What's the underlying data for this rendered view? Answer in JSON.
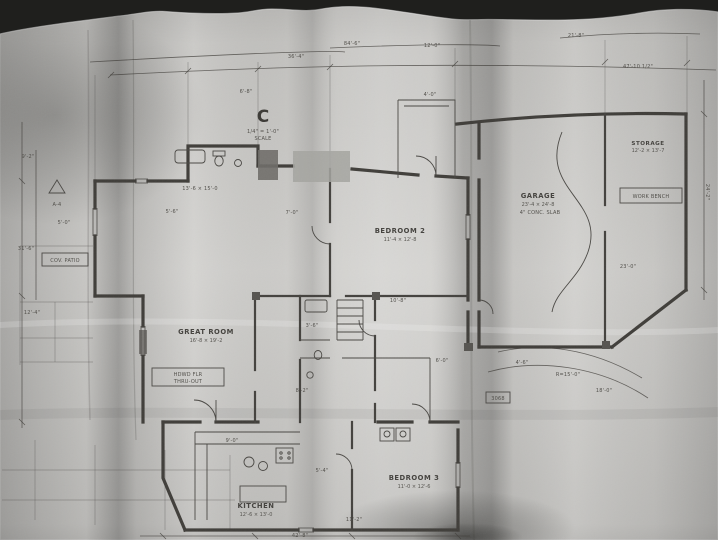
{
  "scene": {
    "type": "photograph of an architectural floor-plan blueprint on curled paper",
    "background_color": "#1f1f1d",
    "paper_color": "#cfcecb",
    "ink_color": "#403e3a",
    "shadow_color": "#8e8c88"
  },
  "plan": {
    "symbols": {
      "north_marker": "C",
      "triangle_note": "A-4"
    },
    "rooms": {
      "garage": {
        "label": "GARAGE",
        "dims": "23'-4 × 24'-8"
      },
      "storage": {
        "label": "STORAGE",
        "dims": "12'-2 × 13'-7"
      },
      "bedroom2": {
        "label": "BEDROOM 2",
        "dims": "11'-4 × 12'-8"
      },
      "great_room": {
        "label": "GREAT ROOM",
        "dims": "16'-8 × 19'-2"
      },
      "kitchen": {
        "label": "KITCHEN",
        "dims": "12'-6 × 13'-0"
      },
      "bedroom3": {
        "label": "BEDROOM 3",
        "dims": "11'-0 × 12'-6"
      }
    },
    "boxes": {
      "patio": "COV. PATIO",
      "workbench": "WORK BENCH",
      "door_tag": "3068"
    },
    "notes": {
      "scale_1": "1/4\" = 1'-0\"",
      "scale_2": "SCALE",
      "floor_1": "HDWD FLR",
      "floor_2": "THRU-OUT",
      "slab": "4\" CONC. SLAB"
    },
    "annotations": [
      {
        "x": 352,
        "y": 45,
        "t": "84'-6\""
      },
      {
        "x": 296,
        "y": 58,
        "t": "36'-4\""
      },
      {
        "x": 432,
        "y": 47,
        "t": "12'-0\""
      },
      {
        "x": 576,
        "y": 37,
        "t": "21'-8\""
      },
      {
        "x": 638,
        "y": 68,
        "t": "47'-10 1/2\""
      },
      {
        "x": 246,
        "y": 93,
        "t": "6'-8\""
      },
      {
        "x": 430,
        "y": 96,
        "t": "4'-0\""
      },
      {
        "x": 28,
        "y": 158,
        "t": "9'-2\""
      },
      {
        "x": 26,
        "y": 250,
        "t": "31'-6\""
      },
      {
        "x": 32,
        "y": 314,
        "t": "12'-4\""
      },
      {
        "x": 64,
        "y": 224,
        "t": "5'-0\""
      },
      {
        "x": 200,
        "y": 190,
        "t": "13'-6 × 15'-0"
      },
      {
        "x": 172,
        "y": 213,
        "t": "5'-6\""
      },
      {
        "x": 292,
        "y": 214,
        "t": "7'-0\""
      },
      {
        "x": 312,
        "y": 327,
        "t": "3'-6\""
      },
      {
        "x": 398,
        "y": 302,
        "t": "10'-8\""
      },
      {
        "x": 442,
        "y": 362,
        "t": "6'-0\""
      },
      {
        "x": 302,
        "y": 392,
        "t": "8'-2\""
      },
      {
        "x": 232,
        "y": 442,
        "t": "9'-0\""
      },
      {
        "x": 322,
        "y": 472,
        "t": "5'-4\""
      },
      {
        "x": 354,
        "y": 521,
        "t": "11'-2\""
      },
      {
        "x": 628,
        "y": 268,
        "t": "23'-0\""
      },
      {
        "x": 522,
        "y": 364,
        "t": "4'-6\""
      },
      {
        "x": 568,
        "y": 376,
        "t": "R=15'-0\""
      },
      {
        "x": 604,
        "y": 392,
        "t": "18'-0\""
      },
      {
        "x": 300,
        "y": 537,
        "t": "42'-8\""
      },
      {
        "x": 706,
        "y": 192,
        "t": "24'-2\"",
        "rot": 90
      }
    ]
  }
}
